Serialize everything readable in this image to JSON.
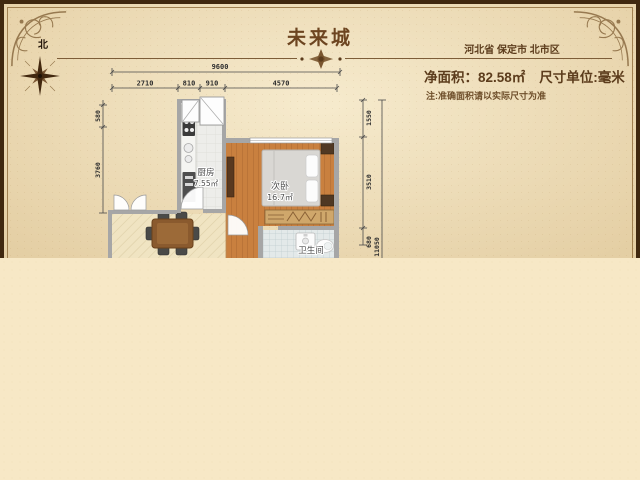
{
  "header": {
    "title": "未来城",
    "location": "河北省 保定市 北市区",
    "net_area_label": "净面积：",
    "net_area_value": "82.58㎡",
    "unit_text": "尺寸单位:毫米",
    "note": "注:准确面积请以实际尺寸为准"
  },
  "compass": {
    "north_label": "北"
  },
  "rooms": [
    {
      "name": "厨房",
      "area": "7.55㎡"
    },
    {
      "name": "次卧",
      "area": "16.7㎡"
    },
    {
      "name": "卫生间",
      "area": ""
    }
  ],
  "dimensions": {
    "top_total": "9600",
    "top_segments": [
      "2710",
      "810",
      "910",
      "4570"
    ],
    "left_segments": [
      "580",
      "3760"
    ],
    "right_segments": [
      "1550",
      "3510",
      "680"
    ],
    "right_total": "11050"
  },
  "colors": {
    "parchment": "#ecdbb6",
    "frame_dark": "#40280f",
    "accent_brown": "#6d4520",
    "wall_gray": "#a6a6a6",
    "wood_floor": "#c9803f",
    "dining_floor": "#f0e4c2",
    "bath_tile": "#e3e9e9",
    "bottom_background": "#f7e8c6"
  }
}
